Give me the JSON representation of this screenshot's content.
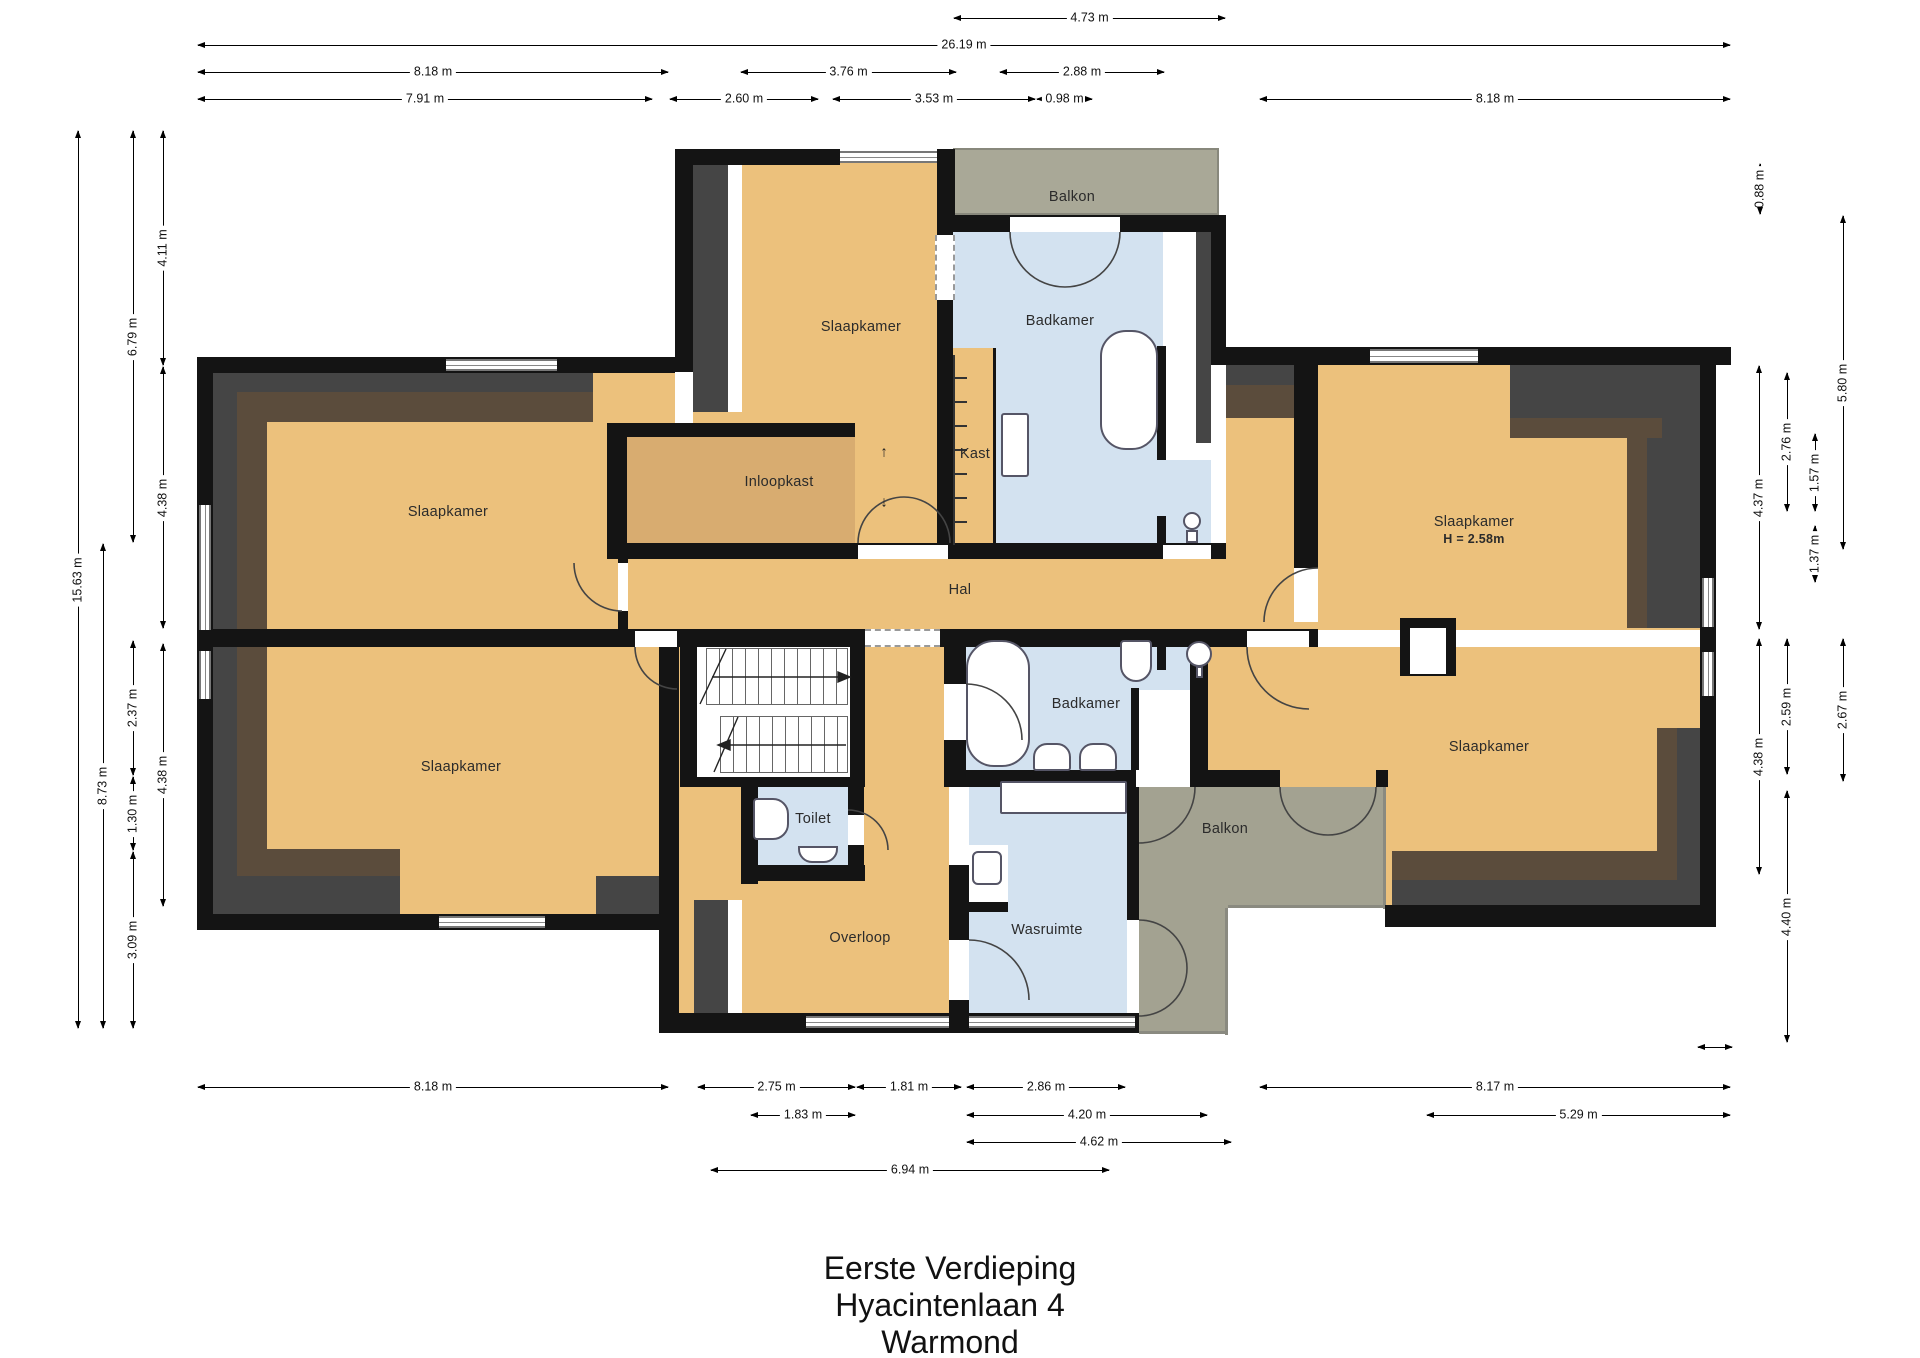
{
  "title": {
    "line1": "Eerste Verdieping",
    "line2": "Hyacintenlaan 4",
    "line3": "Warmond"
  },
  "colors": {
    "floor_tan": "#ecc17c",
    "closet_tan": "#d8ac70",
    "wet_blue": "#d3e2f0",
    "balcony_gray": "#a9a897",
    "wall_black": "#141414",
    "slope_charcoal": "#454545",
    "slope_brown": "#5b4c3c"
  },
  "glyphs": {
    "stair_up": "↑",
    "stair_down": "↓"
  },
  "rooms": [
    {
      "id": "slaapkamer-top-middle",
      "label": "Slaapkamer",
      "x": 861,
      "y": 327
    },
    {
      "id": "badkamer-top",
      "label": "Badkamer",
      "x": 1060,
      "y": 321
    },
    {
      "id": "balkon-top",
      "label": "Balkon",
      "x": 1072,
      "y": 197
    },
    {
      "id": "inloopkast",
      "label": "Inloopkast",
      "x": 779,
      "y": 482
    },
    {
      "id": "kast",
      "label": "Kast",
      "x": 975,
      "y": 454
    },
    {
      "id": "slaapkamer-left-upper",
      "label": "Slaapkamer",
      "x": 448,
      "y": 512
    },
    {
      "id": "slaapkamer-left-lower",
      "label": "Slaapkamer",
      "x": 461,
      "y": 767
    },
    {
      "id": "hal",
      "label": "Hal",
      "x": 960,
      "y": 590
    },
    {
      "id": "slaapkamer-right-upper",
      "label": "Slaapkamer",
      "sub": "H = 2.58m",
      "x": 1474,
      "y": 530
    },
    {
      "id": "slaapkamer-right-lower",
      "label": "Slaapkamer",
      "x": 1489,
      "y": 747
    },
    {
      "id": "toilet",
      "label": "Toilet",
      "x": 813,
      "y": 819
    },
    {
      "id": "badkamer-bottom",
      "label": "Badkamer",
      "x": 1086,
      "y": 704
    },
    {
      "id": "overloop",
      "label": "Overloop",
      "x": 860,
      "y": 938
    },
    {
      "id": "wasruimte",
      "label": "Wasruimte",
      "x": 1047,
      "y": 930
    },
    {
      "id": "balkon-bottom",
      "label": "Balkon",
      "x": 1225,
      "y": 829
    }
  ],
  "dimensions": {
    "horizontal": [
      {
        "label": "4.73 m",
        "x1": 953,
        "x2": 1226,
        "y": 18
      },
      {
        "label": "26.19 m",
        "x1": 197,
        "x2": 1731,
        "y": 45
      },
      {
        "label": "8.18 m",
        "x1": 197,
        "x2": 669,
        "y": 72
      },
      {
        "label": "3.76 m",
        "x1": 740,
        "x2": 957,
        "y": 72
      },
      {
        "label": "2.88 m",
        "x1": 999,
        "x2": 1165,
        "y": 72
      },
      {
        "label": "7.91 m",
        "x1": 197,
        "x2": 653,
        "y": 99
      },
      {
        "label": "2.60 m",
        "x1": 669,
        "x2": 819,
        "y": 99
      },
      {
        "label": "3.53 m",
        "x1": 832,
        "x2": 1036,
        "y": 99
      },
      {
        "label": "0.98 m",
        "x1": 1036,
        "x2": 1093,
        "y": 99
      },
      {
        "label": "8.18 m",
        "x1": 1259,
        "x2": 1731,
        "y": 99
      },
      {
        "label": "8.18 m",
        "x1": 197,
        "x2": 669,
        "y": 1087
      },
      {
        "label": "2.75 m",
        "x1": 697,
        "x2": 856,
        "y": 1087
      },
      {
        "label": "1.81 m",
        "x1": 856,
        "x2": 962,
        "y": 1087
      },
      {
        "label": "2.86 m",
        "x1": 966,
        "x2": 1126,
        "y": 1087
      },
      {
        "label": "8.17 m",
        "x1": 1259,
        "x2": 1731,
        "y": 1087
      },
      {
        "label": "1.83 m",
        "x1": 750,
        "x2": 856,
        "y": 1115
      },
      {
        "label": "4.20 m",
        "x1": 966,
        "x2": 1208,
        "y": 1115
      },
      {
        "label": "5.29 m",
        "x1": 1426,
        "x2": 1731,
        "y": 1115
      },
      {
        "label": "4.62 m",
        "x1": 966,
        "x2": 1232,
        "y": 1142
      },
      {
        "label": "6.94 m",
        "x1": 710,
        "x2": 1110,
        "y": 1170
      },
      {
        "label": "",
        "x1": 1697,
        "x2": 1733,
        "y": 1047
      }
    ],
    "vertical": [
      {
        "label": "15.63 m",
        "x": 78,
        "y1": 130,
        "y2": 1029
      },
      {
        "label": "8.73 m",
        "x": 103,
        "y1": 543,
        "y2": 1029
      },
      {
        "label": "6.79 m",
        "x": 133,
        "y1": 130,
        "y2": 543
      },
      {
        "label": "2.37 m",
        "x": 133,
        "y1": 640,
        "y2": 776
      },
      {
        "label": "1.30 m",
        "x": 133,
        "y1": 776,
        "y2": 851
      },
      {
        "label": "3.09 m",
        "x": 133,
        "y1": 851,
        "y2": 1029
      },
      {
        "label": "4.11 m",
        "x": 163,
        "y1": 130,
        "y2": 366
      },
      {
        "label": "4.38 m",
        "x": 163,
        "y1": 366,
        "y2": 629
      },
      {
        "label": "4.38 m",
        "x": 163,
        "y1": 643,
        "y2": 907
      },
      {
        "label": "0.88 m",
        "x": 1760,
        "y1": 163,
        "y2": 215
      },
      {
        "label": "5.80 m",
        "x": 1843,
        "y1": 215,
        "y2": 550
      },
      {
        "label": "4.37 m",
        "x": 1759,
        "y1": 365,
        "y2": 630
      },
      {
        "label": "2.76 m",
        "x": 1787,
        "y1": 372,
        "y2": 512
      },
      {
        "label": "1.57 m",
        "x": 1815,
        "y1": 433,
        "y2": 512
      },
      {
        "label": "1.37 m",
        "x": 1815,
        "y1": 525,
        "y2": 583
      },
      {
        "label": "2.59 m",
        "x": 1787,
        "y1": 638,
        "y2": 775
      },
      {
        "label": "2.67 m",
        "x": 1843,
        "y1": 638,
        "y2": 782
      },
      {
        "label": "4.38 m",
        "x": 1759,
        "y1": 638,
        "y2": 875
      },
      {
        "label": "4.40 m",
        "x": 1787,
        "y1": 790,
        "y2": 1043
      }
    ]
  }
}
